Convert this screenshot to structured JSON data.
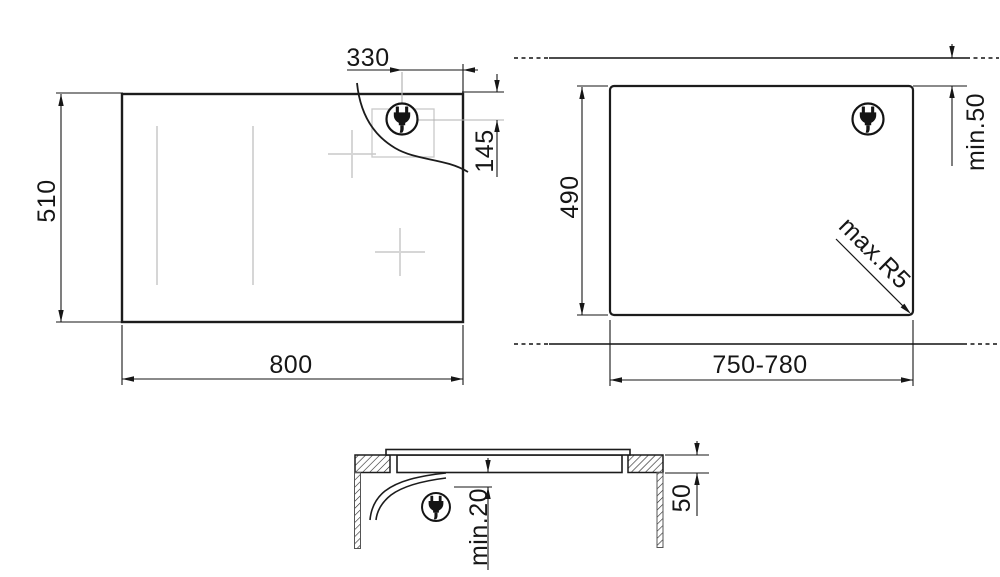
{
  "drawing": {
    "kind": "hob installation dimensions",
    "colors": {
      "line": "#1c1c1c",
      "aux_gray": "#d6d6d6",
      "background": "#ffffff"
    },
    "views": {
      "plan": {
        "name": "hob top view",
        "width_label": "800",
        "depth_label": "510",
        "plug_offset_from_right_label": "330",
        "plug_offset_from_top_label": "145"
      },
      "cutout": {
        "name": "worktop cutout view",
        "width_label": "750-780",
        "depth_label": "490",
        "rear_clearance_label": "min.50",
        "corner_radius_label": "max.R5"
      },
      "section": {
        "name": "side section view",
        "worktop_thickness_label": "50",
        "bottom_clearance_label": "min.20"
      }
    },
    "icons": {
      "plug": "power-plug"
    }
  }
}
